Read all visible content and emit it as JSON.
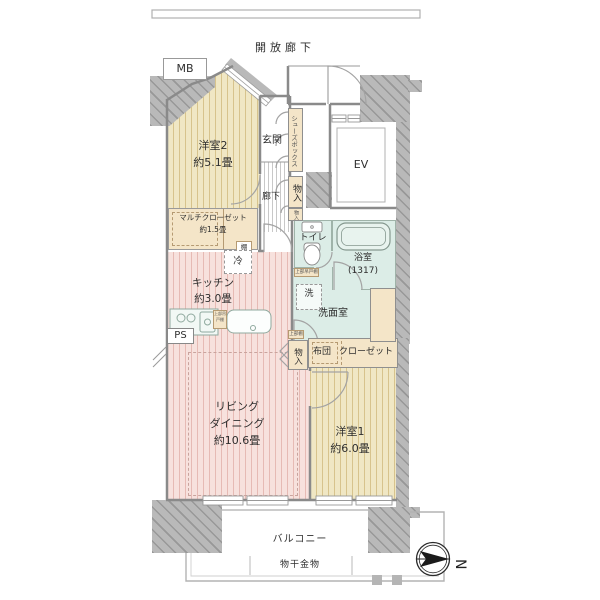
{
  "floorplan": {
    "open_corridor": "開放廊下",
    "mb": "MB",
    "ev": "EV",
    "ps": "PS",
    "bedroom2": {
      "name": "洋室2",
      "size": "約5.1畳"
    },
    "entrance": "玄関",
    "hallway": "廊下",
    "shoes_box": "シューズボックス",
    "storage_entry_1": "物入",
    "storage_entry_2": "物入",
    "multi_closet": {
      "name": "マルチクローゼット",
      "size": "約1.5畳"
    },
    "shelf": "棚",
    "refrigerator": "冷",
    "toilet": "トイレ",
    "bathroom": {
      "name": "浴室",
      "size": "(1317)"
    },
    "washer": "洗",
    "washroom": "洗面室",
    "kitchen": {
      "name": "キッチン",
      "size": "約3.0畳"
    },
    "living": {
      "line1": "リビング",
      "line2": "ダイニング",
      "size": "約10.6畳"
    },
    "storage_living": "物入",
    "futon": "布団",
    "closet": "クローゼット",
    "bedroom1": {
      "name": "洋室1",
      "size": "約6.0畳"
    },
    "balcony": "バルコニー",
    "laundry_hardware": "物干金物",
    "upper_cabinet_kitchen": "上部吊戸棚",
    "upper_cabinet_wash": "上部吊戸棚",
    "upper_shelf": "上部棚",
    "north": "N",
    "colors": {
      "wood_floor": "#f0e7c4",
      "wood_stripe": "#d7c38c",
      "ldk_floor": "#f7e1dd",
      "ldk_stripe": "#e6bab4",
      "wet_area": "#dcede7",
      "closet": "#f4e5c8",
      "wall": "#b9b9b9",
      "counter": "#d8ece3"
    }
  }
}
